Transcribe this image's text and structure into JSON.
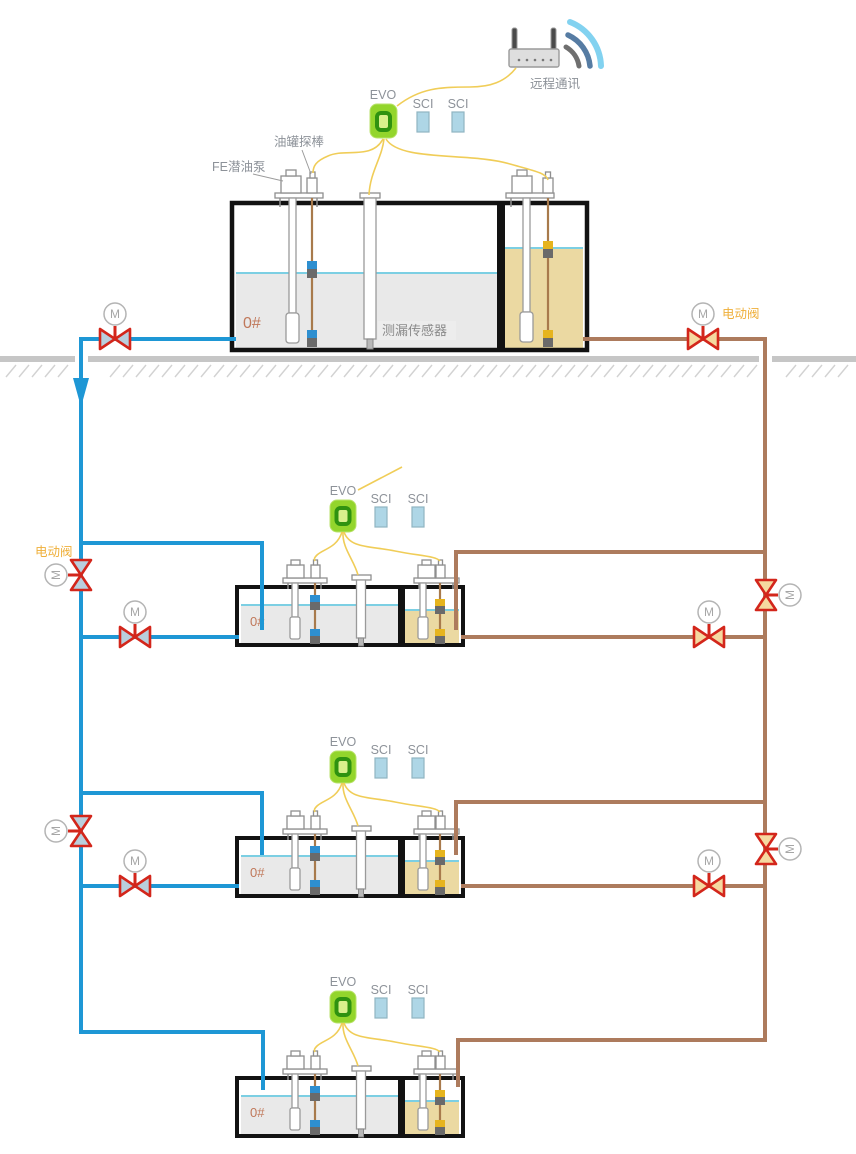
{
  "remote": {
    "label": "远程通讯"
  },
  "annotations": {
    "pump_label": "FE潜油泵",
    "probe_label": "油罐探棒",
    "leak_sensor_label": "测漏传感器",
    "electric_valve_label": "电动阀",
    "motor_letter": "M"
  },
  "tanks": [
    {
      "fuel_label": "0#",
      "evo_label": "EVO",
      "sci1_label": "SCI",
      "sci2_label": "SCI"
    },
    {
      "fuel_label": "0#",
      "evo_label": "EVO",
      "sci1_label": "SCI",
      "sci2_label": "SCI"
    },
    {
      "fuel_label": "0#",
      "evo_label": "EVO",
      "sci1_label": "SCI",
      "sci2_label": "SCI"
    },
    {
      "fuel_label": "0#",
      "evo_label": "EVO",
      "sci1_label": "SCI",
      "sci2_label": "SCI"
    }
  ],
  "colors": {
    "pipe_blue": "#1e97d5",
    "pipe_brown": "#ad7b5d",
    "valve_red": "#d3261b",
    "wire_yellow": "#f0cd58",
    "evo_green": "#93d52c",
    "sci_blue": "#aed6e6",
    "diesel_fluid": "#e9e9e9",
    "gasoline_fluid": "#ebd9a2",
    "label_orange": "#efaf3a",
    "fuel_label_color": "#c0785a"
  }
}
